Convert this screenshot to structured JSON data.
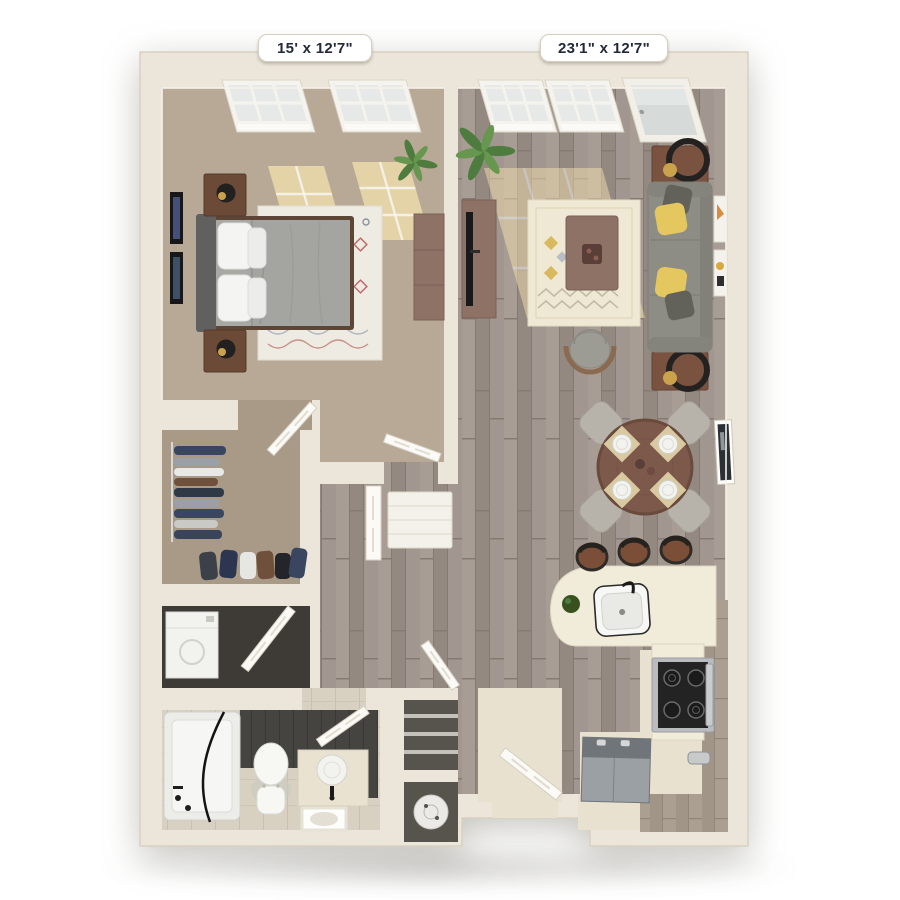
{
  "page": {
    "type": "3d-floor-plan",
    "background": "#ffffff"
  },
  "dimension_labels": {
    "bedroom": "15' x 12'7\"",
    "living_room": "23'1\" x 12'7\""
  },
  "rooms": [
    "bedroom",
    "living-dining-area",
    "walk-in-closet",
    "hallway",
    "laundry-closet",
    "bathroom",
    "linen-closet",
    "utility-closet",
    "entry",
    "kitchen"
  ],
  "furniture": [
    "bed",
    "nightstands",
    "table-lamps",
    "wall-art",
    "area-rugs",
    "dresser",
    "potted-plants",
    "tv-console",
    "tv",
    "sofa",
    "throw-pillows",
    "end-tables",
    "round-mirrors",
    "coffee-table",
    "accent-chair",
    "dining-table",
    "dining-chairs",
    "place-settings",
    "kitchen-counter",
    "kitchen-sink",
    "bar-stools",
    "range",
    "refrigerator",
    "cabinets",
    "washer-dryer",
    "hanging-clothes",
    "bathtub",
    "toilet",
    "vanity-sink",
    "linen-shelves",
    "water-heater",
    "windows",
    "balcony-door",
    "interior-doors",
    "front-door"
  ],
  "colors": {
    "wall": "#ece6da",
    "wall_edge": "#d8d1c1",
    "door": "#fbfaf7",
    "carpet": "#b7a996",
    "carpet_closet": "#a89a86",
    "bath_floor": "#d8d1c2",
    "dark_tile": "#454441",
    "kitchen_floor": "#e8e1cf",
    "counter": "#f1ebda",
    "cabinet": "#ab9f92",
    "sofa": "#8d8d85",
    "pillow_yellow": "#e4c75f",
    "pillow_dark": "#62625a",
    "rug_living": "#efe8d4",
    "rug_bedroom": "#edebe2",
    "comforter": "#a8a8a4",
    "headboard": "#60605e",
    "bedframe": "#5d4636",
    "nightstand": "#6b4a38",
    "mauve": "#8d7265",
    "dining_table": "#7c594a",
    "chair_gray": "#b7b3aa",
    "stool": "#7b4f37",
    "plant": "#4e7c3f",
    "plant_light": "#67974f",
    "sunlight": "#f3dfae",
    "fridge": "#9aa0a3",
    "fridge_front": "#70757a",
    "label_text": "#232939",
    "label_bg": "#ffffff"
  }
}
